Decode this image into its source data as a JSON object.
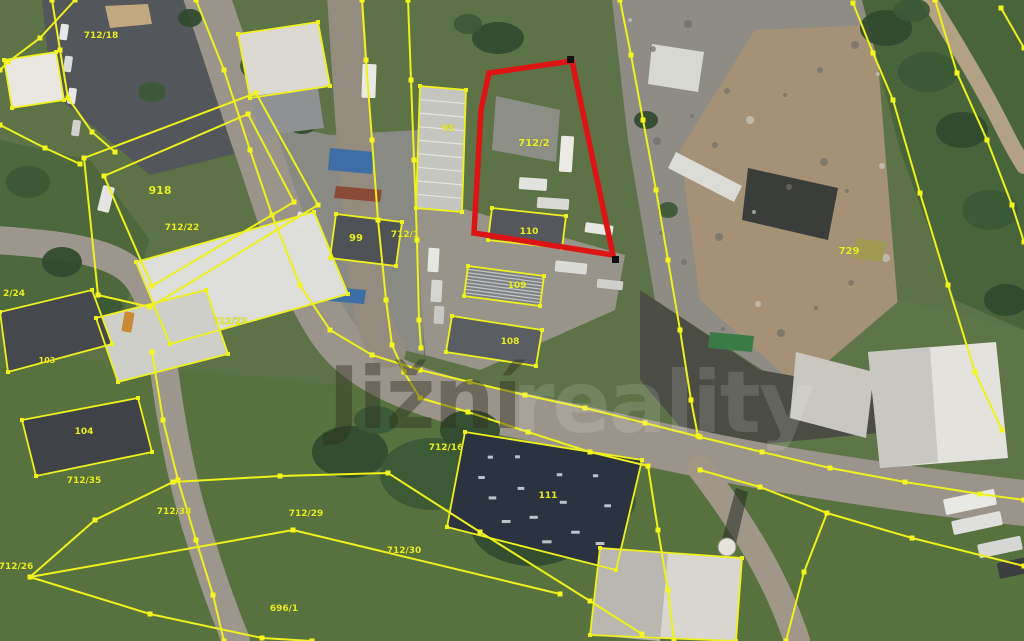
{
  "map": {
    "watermark": {
      "text": "Jižní",
      "faint_text": "reality"
    },
    "palette": {
      "boundary_yellow": "#eef11c",
      "highlight_red": "#dc1414",
      "label_yellow": "#e8ee21",
      "grass": "#5d7247",
      "road": "#9b948a",
      "asphalt": "#53565a",
      "gravel": "#8e8c85"
    },
    "highlight_parcel": {
      "label": "712/2",
      "points": "489,73 572,61 613,255 474,233 481,110",
      "markers": [
        [
          615,
          259
        ],
        [
          570,
          59
        ]
      ]
    },
    "labels": [
      {
        "text": "712/18",
        "x": 101,
        "y": 38,
        "size": 9
      },
      {
        "text": "918",
        "x": 160,
        "y": 194,
        "size": 11
      },
      {
        "text": "712/22",
        "x": 182,
        "y": 230,
        "size": 9
      },
      {
        "text": "2/24",
        "x": 14,
        "y": 296,
        "size": 9
      },
      {
        "text": "712/23",
        "x": 230,
        "y": 324,
        "size": 9
      },
      {
        "text": "99",
        "x": 356,
        "y": 241,
        "size": 10
      },
      {
        "text": "712/1",
        "x": 405,
        "y": 237,
        "size": 9
      },
      {
        "text": "95",
        "x": 448,
        "y": 131,
        "size": 9
      },
      {
        "text": "712/2",
        "x": 534,
        "y": 146,
        "size": 10
      },
      {
        "text": "110",
        "x": 529,
        "y": 234,
        "size": 9
      },
      {
        "text": "109",
        "x": 517,
        "y": 288,
        "size": 9
      },
      {
        "text": "108",
        "x": 510,
        "y": 344,
        "size": 9
      },
      {
        "text": "729",
        "x": 849,
        "y": 254,
        "size": 10
      },
      {
        "text": "103",
        "x": 47,
        "y": 363,
        "size": 8
      },
      {
        "text": "104",
        "x": 84,
        "y": 434,
        "size": 9
      },
      {
        "text": "712/35",
        "x": 84,
        "y": 483,
        "size": 9
      },
      {
        "text": "712/16",
        "x": 446,
        "y": 450,
        "size": 9
      },
      {
        "text": "111",
        "x": 548,
        "y": 498,
        "size": 9
      },
      {
        "text": "712/29",
        "x": 306,
        "y": 516,
        "size": 9
      },
      {
        "text": "712/38",
        "x": 174,
        "y": 514,
        "size": 9
      },
      {
        "text": "712/30",
        "x": 404,
        "y": 553,
        "size": 9
      },
      {
        "text": "712/26",
        "x": 16,
        "y": 569,
        "size": 9
      },
      {
        "text": "696/1",
        "x": 284,
        "y": 611,
        "size": 9
      }
    ],
    "areas": [
      {
        "name": "field-bottom",
        "points": "0,350 430,395 650,470 1024,520 1024,641 0,641",
        "fill": "#57713f"
      },
      {
        "name": "grass-mid-left",
        "points": "0,140 90,160 150,240 120,320 0,330",
        "fill": "#4c683c"
      },
      {
        "name": "asphalt-yard-712-18",
        "points": "42,0 214,0 258,148 150,175 52,92",
        "fill": "#53565a"
      },
      {
        "name": "asphalt-yard-99",
        "points": "248,118 330,135 418,130 424,355 318,330 268,215",
        "fill": "#8a8a84"
      },
      {
        "name": "dirt-center",
        "points": "415,195 625,255 615,310 480,370 425,355",
        "fill": "#99948a"
      },
      {
        "name": "gravel-plateau",
        "points": "612,0 875,0 870,130 900,390 770,375 655,300 628,140",
        "fill": "#8e8c85"
      },
      {
        "name": "dirt-tan-right",
        "points": "755,30 875,25 905,395 790,380 700,300 680,150",
        "fill": "#a59276"
      },
      {
        "name": "trees-right-band",
        "points": "862,0 1024,0 1024,330 955,300 900,150",
        "fill": "#47643a"
      },
      {
        "name": "grass-right-low",
        "points": "900,300 1024,330 1024,520 700,470",
        "fill": "#5e7548"
      },
      {
        "name": "rubble-band",
        "points": "640,290 760,370 900,395 910,430 700,450 640,380",
        "fill": "#4b4d45"
      },
      {
        "name": "sand-patch",
        "points": "105,6 148,4 152,24 110,28",
        "fill": "#c2a87e"
      },
      {
        "name": "junk-pile",
        "points": "496,96 560,110 556,162 492,150",
        "fill": "#8d8f87"
      },
      {
        "name": "white-heap",
        "points": "652,44 704,52 698,92 648,84",
        "fill": "#d8d8d2"
      },
      {
        "name": "dark-heap",
        "points": "748,168 838,188 828,240 742,220",
        "fill": "#3b3d3a"
      },
      {
        "name": "white-rubble-heap",
        "points": "796,352 874,372 866,438 790,418",
        "fill": "#c9c7c0"
      }
    ],
    "roads": [
      {
        "name": "road-main",
        "d": "M206,-5 C232,70 246,118 260,156 C286,236 306,296 334,334 C366,378 432,398 502,412 C592,430 682,452 762,466 C862,483 952,495 1024,503",
        "width": 46,
        "color": "#9b948a"
      },
      {
        "name": "road-center",
        "d": "M345,-5 C351,90 357,180 365,258 C370,314 377,336 388,350",
        "width": 36,
        "color": "#958c80"
      },
      {
        "name": "road-left",
        "d": "M-5,240 C60,244 96,250 121,264 C146,278 156,312 163,362 C171,422 181,482 201,542 C213,582 226,616 236,641",
        "width": 28,
        "color": "#9d968c"
      },
      {
        "name": "road-bottom-right",
        "d": "M700,468 C740,520 776,576 797,641",
        "width": 26,
        "color": "#a09788"
      },
      {
        "name": "path-top-right",
        "d": "M926,-5 C953,38 983,88 1003,128 C1013,148 1019,158 1024,166",
        "width": 16,
        "color": "#b3a183"
      }
    ],
    "vegetation": [
      [
        258,
        66,
        18,
        14
      ],
      [
        302,
        122,
        16,
        12
      ],
      [
        152,
        92,
        14,
        10
      ],
      [
        190,
        18,
        12,
        9
      ],
      [
        28,
        182,
        22,
        16
      ],
      [
        62,
        262,
        20,
        15
      ],
      [
        108,
        306,
        14,
        10
      ],
      [
        498,
        38,
        26,
        16
      ],
      [
        468,
        24,
        14,
        10
      ],
      [
        350,
        452,
        38,
        26
      ],
      [
        432,
        474,
        52,
        36
      ],
      [
        532,
        524,
        62,
        42
      ],
      [
        606,
        502,
        30,
        22
      ],
      [
        470,
        430,
        30,
        20
      ],
      [
        376,
        420,
        22,
        14
      ],
      [
        886,
        28,
        26,
        18
      ],
      [
        928,
        72,
        30,
        20
      ],
      [
        962,
        130,
        26,
        18
      ],
      [
        990,
        210,
        28,
        20
      ],
      [
        1006,
        300,
        22,
        16
      ],
      [
        912,
        10,
        18,
        12
      ],
      [
        646,
        120,
        12,
        9
      ],
      [
        668,
        210,
        10,
        8
      ]
    ],
    "buildings": [
      {
        "name": "barn-top-left",
        "points": "4,60 56,52 64,100 12,108",
        "fill": "#e9e7df",
        "outline": true
      },
      {
        "name": "white-top",
        "points": "238,34 318,22 330,86 250,98",
        "fill": "#dbd9d1",
        "outline": true
      },
      {
        "name": "shed-row",
        "points": "252,96 318,88 324,128 258,136",
        "fill": "#8f9193",
        "outline": false
      },
      {
        "name": "hall-95",
        "points": "420,86 466,90 462,212 416,208",
        "fill": "#c6c6c0",
        "outline": true,
        "stripes": true
      },
      {
        "name": "hall-99",
        "points": "336,214 402,222 396,266 330,258",
        "fill": "#4e5256",
        "outline": true
      },
      {
        "name": "blue-roof-1",
        "points": "330,148 374,152 372,174 328,170",
        "fill": "#3e6ea6",
        "outline": false
      },
      {
        "name": "containers-red",
        "points": "336,186 382,190 380,202 334,198",
        "fill": "#8a4a38",
        "outline": false
      },
      {
        "name": "blue-roof-2",
        "points": "320,286 366,290 364,304 318,300",
        "fill": "#3e6ea6",
        "outline": false
      },
      {
        "name": "hall-110",
        "points": "492,208 566,216 562,248 488,240",
        "fill": "#54585c",
        "outline": true
      },
      {
        "name": "hall-109",
        "points": "468,266 544,276 540,306 464,296",
        "fill": "#7e8284",
        "outline": true,
        "stripes": true
      },
      {
        "name": "hall-108",
        "points": "452,316 542,330 536,366 446,352",
        "fill": "#5a5e62",
        "outline": true
      },
      {
        "name": "white-hall-1",
        "points": "136,262 314,212 348,294 170,344",
        "fill": "#dededa",
        "outline": true
      },
      {
        "name": "white-hall-2",
        "points": "96,318 206,290 228,354 118,382",
        "fill": "#cfcfca",
        "outline": true
      },
      {
        "name": "hall-103",
        "points": "0,312 92,290 112,344 8,372",
        "fill": "#45494d",
        "outline": true
      },
      {
        "name": "hall-104",
        "points": "22,420 138,398 152,452 36,476",
        "fill": "#3f4347",
        "outline": true
      },
      {
        "name": "hall-111",
        "points": "465,432 642,460 616,570 447,527",
        "fill": "#2c3340",
        "outline": true,
        "speckles": true
      },
      {
        "name": "bldg-bottom-right",
        "points": "600,548 742,558 736,641 590,635",
        "fill": "#d8d6ce",
        "outline": true
      },
      {
        "name": "bldg-bottom-right-roof",
        "points": "600,548 668,553 660,641 590,635",
        "fill": "#b9b7b0",
        "outline": false
      },
      {
        "name": "warehouse-right",
        "points": "868,352 996,342 1008,458 880,468",
        "fill": "#e3e2dc",
        "outline": false
      },
      {
        "name": "warehouse-right-roof",
        "points": "868,352 930,347 938,462 880,468",
        "fill": "#c8c7c1",
        "outline": false
      },
      {
        "name": "green-container",
        "points": "710,332 754,336 752,352 708,348",
        "fill": "#3a7a46",
        "outline": false
      },
      {
        "name": "trailer-top-right",
        "points": "676,152 742,186 734,202 668,168",
        "fill": "#dcdcd6",
        "outline": false
      },
      {
        "name": "excavator",
        "points": "856,238 886,242 882,262 852,258",
        "fill": "#a09a55",
        "outline": false
      }
    ],
    "tower": {
      "cx": 727,
      "cy": 547,
      "r": 9,
      "shadow": "722,540 736,488 748,492 736,544"
    },
    "vehicles": [
      [
        60,
        24,
        8,
        16,
        8,
        "#e8e8e8"
      ],
      [
        64,
        56,
        8,
        16,
        8,
        "#dcdcdc"
      ],
      [
        68,
        88,
        8,
        16,
        8,
        "#e8e8e8"
      ],
      [
        72,
        120,
        8,
        16,
        8,
        "#d0d0cc"
      ],
      [
        100,
        186,
        12,
        26,
        14,
        "#e4e4e0"
      ],
      [
        123,
        312,
        10,
        20,
        10,
        "#c98a36"
      ],
      [
        296,
        212,
        8,
        15,
        18,
        "#e0e0dc"
      ],
      [
        362,
        64,
        14,
        34,
        2,
        "#e9e9e5"
      ],
      [
        428,
        248,
        11,
        24,
        3,
        "#e6e6e2"
      ],
      [
        431,
        280,
        11,
        22,
        3,
        "#d4d4d0"
      ],
      [
        434,
        306,
        10,
        18,
        3,
        "#c8c8c4"
      ],
      [
        560,
        136,
        13,
        36,
        4,
        "#eceae4"
      ],
      [
        519,
        178,
        28,
        12,
        4,
        "#e2e2de"
      ],
      [
        537,
        198,
        32,
        11,
        4,
        "#d8d8d4"
      ],
      [
        585,
        224,
        28,
        10,
        8,
        "#e6e6e2"
      ],
      [
        555,
        262,
        32,
        11,
        6,
        "#dadad6"
      ],
      [
        597,
        280,
        26,
        9,
        6,
        "#cfcfcb"
      ],
      [
        944,
        494,
        52,
        16,
        -12,
        "#e8e8e4"
      ],
      [
        952,
        516,
        50,
        14,
        -12,
        "#dfdfdb"
      ],
      [
        978,
        540,
        44,
        14,
        -12,
        "#d6d6d2"
      ],
      [
        998,
        560,
        30,
        16,
        -12,
        "#3c3e40"
      ]
    ],
    "boundaries": [
      {
        "name": "road-west-north-edge",
        "points": "196,0 224,70 250,150 272,215 300,285 330,330 372,355 420,370 470,382 525,395 585,408 645,423 700,437 762,452 830,468 905,482 980,494 1024,500",
        "closed": false
      },
      {
        "name": "center-road-east-edge",
        "points": "362,0 366,60 372,140 378,220 386,300 392,345 404,372 420,398 468,412 528,432 590,452 648,466 658,530 668,590 674,641",
        "closed": false
      },
      {
        "name": "east-of-highlight",
        "points": "620,0 631,55 643,120 656,190 668,260 680,330 691,400 698,436",
        "closed": false
      },
      {
        "name": "west-of-hall-95",
        "points": "408,0 411,80 414,160 417,240 419,320 421,348",
        "closed": false
      },
      {
        "name": "parcel-918-outer",
        "points": "84,158 256,93 318,205 150,307 98,295",
        "closed": true
      },
      {
        "name": "parcel-918-inner",
        "points": "104,176 248,114 294,202 152,286",
        "closed": true
      },
      {
        "name": "top-left-corner-a",
        "points": "0,125 45,148 80,164",
        "closed": false
      },
      {
        "name": "top-left-corner-b",
        "points": "75,0 40,38 8,62 0,70",
        "closed": false
      },
      {
        "name": "yard-west-edge",
        "points": "52,0 60,50 68,98 92,132 115,152",
        "closed": false
      },
      {
        "name": "field-line-se",
        "points": "388,473 480,532 590,601 642,634",
        "closed": false
      },
      {
        "name": "field-line-west",
        "points": "388,473 280,476 173,482 95,520 30,577",
        "closed": false
      },
      {
        "name": "field-line-mid",
        "points": "30,577 293,530 560,594",
        "closed": false
      },
      {
        "name": "field-line-south",
        "points": "30,577 150,614 262,638 312,641",
        "closed": false
      },
      {
        "name": "left-road-east-edge",
        "points": "152,352 163,420 178,480 196,540 213,595 224,641",
        "closed": false
      },
      {
        "name": "bottom-right-a",
        "points": "700,470 760,487 827,513 912,538 1024,566",
        "closed": false
      },
      {
        "name": "bottom-right-b",
        "points": "827,513 804,572 786,641",
        "closed": false
      },
      {
        "name": "tree-edge-right",
        "points": "853,3 873,53 893,100 920,193 948,285 975,372 1002,430",
        "closed": false
      },
      {
        "name": "right-edge-line",
        "points": "935,0 957,73 987,140 1012,205 1024,242",
        "closed": false
      },
      {
        "name": "corner-top-right",
        "points": "1001,8 1024,48",
        "closed": false
      }
    ]
  }
}
